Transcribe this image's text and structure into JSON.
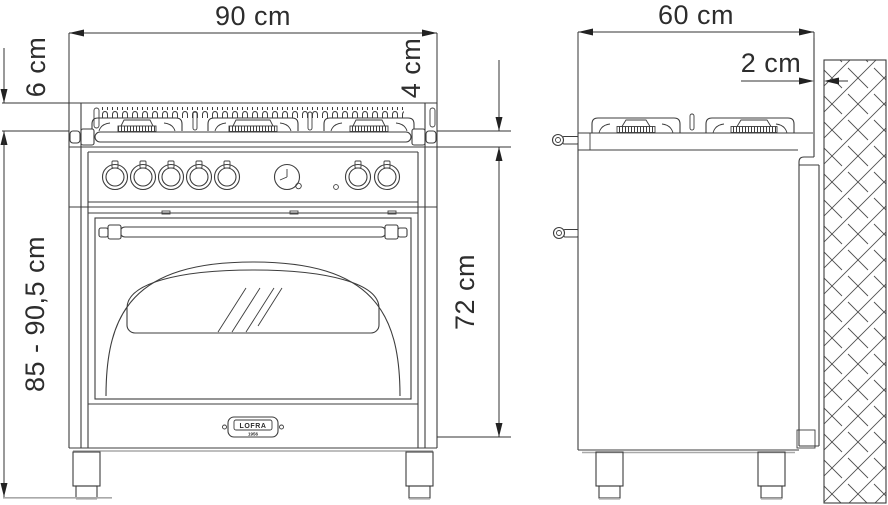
{
  "colors": {
    "line": "#3d3d3d",
    "light_line": "#a9a9a9",
    "dimension_line": "#333333",
    "text": "#2d2d2d",
    "background": "#ffffff"
  },
  "dimensions": {
    "front_width": "90 cm",
    "grate_height": "6 cm",
    "hob_rim_height": "4 cm",
    "overall_height": "85 - 90,5 cm",
    "body_height": "72 cm",
    "depth": "60 cm",
    "wall_clearance": "2 cm"
  },
  "badge": {
    "brand": "LOFRA",
    "year": "1956"
  }
}
